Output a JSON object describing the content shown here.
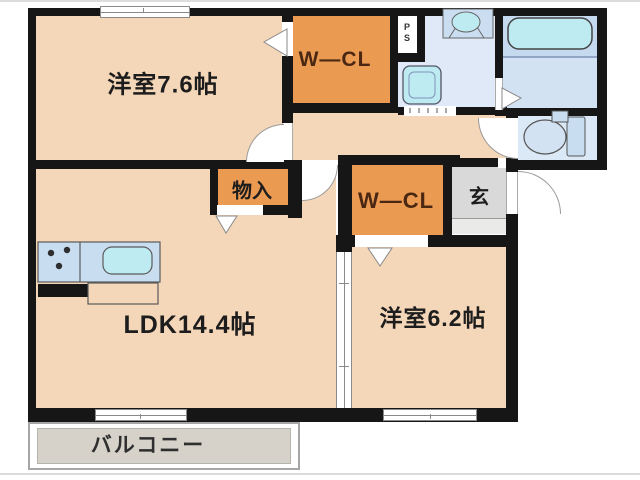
{
  "floorplan": {
    "type": "apartment-floor-plan",
    "rooms": {
      "bedroom1": {
        "label": "洋室7.6帖"
      },
      "wcl1": {
        "label": "W―CL"
      },
      "ps": {
        "label": "PS"
      },
      "storage": {
        "label": "物入"
      },
      "wcl2": {
        "label": "W―CL"
      },
      "genkan": {
        "label": "玄"
      },
      "ldk": {
        "label": "LDK14.4帖"
      },
      "bedroom2": {
        "label": "洋室6.2帖"
      },
      "balcony": {
        "label": "バルコニー"
      }
    },
    "fixtures": {
      "bathtub": "bathtub-icon",
      "toilet": "toilet-icon",
      "vanity": "vanity-sink-icon",
      "washer_pan": "washing-machine-pan-icon",
      "kitchen": "kitchen-counter-icon",
      "stove": "stove-burners-icon"
    }
  },
  "colors": {
    "room_fill": "#F4D6B8",
    "closet_fill": "#EB9A52",
    "wall": "#161616",
    "washroom_fill": "#DFE9F7",
    "bathroom_fill": "#D3E2F2",
    "bathroom_upper_fill": "#C5DAEE",
    "toilet_fill": "#DBE8F6",
    "fixture_cyan": "#BEEBF2",
    "counter_blue": "#C9DDF0",
    "entrance_gray": "#D9D9D9",
    "balcony_gray": "#D6D2CA",
    "closet_text": "#4A2712",
    "text": "#1D1D1D"
  }
}
